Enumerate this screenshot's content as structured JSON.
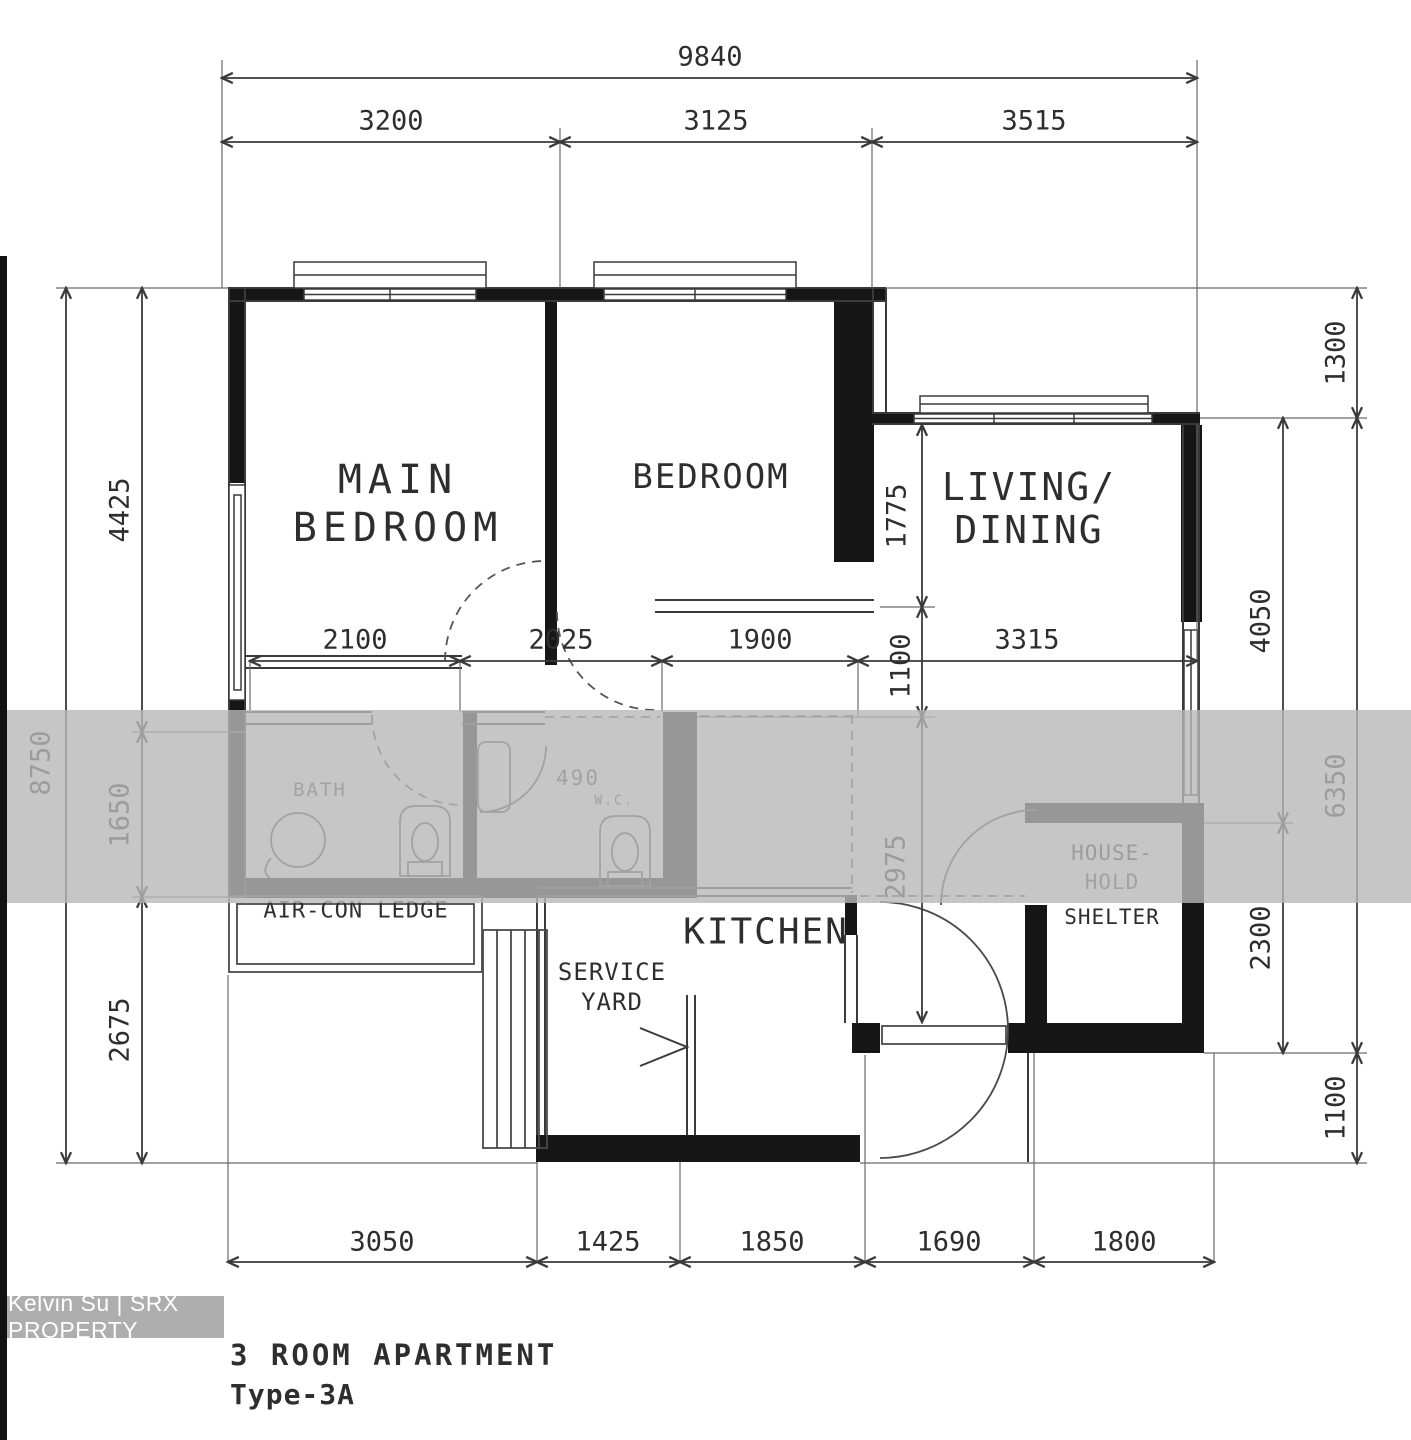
{
  "plan": {
    "title_line1": "3 ROOM APARTMENT",
    "title_line2": "Type-3A",
    "watermark_badge": "Kelvin Su | SRX PROPERTY",
    "rooms": {
      "main_bedroom": [
        "MAIN",
        "BEDROOM"
      ],
      "bedroom": "BEDROOM",
      "living_dining": [
        "LIVING/",
        "DINING"
      ],
      "kitchen": "KITCHEN",
      "service_yard": [
        "SERVICE",
        "YARD"
      ],
      "household_shelter": [
        "HOUSE-",
        "HOLD",
        "SHELTER"
      ],
      "aircon_ledge": "AIR-CON LEDGE",
      "bath1": "BATH",
      "bath2": [
        "490",
        "W.C."
      ]
    },
    "dimensions": {
      "top_total": "9840",
      "top_segments": [
        "3200",
        "3125",
        "3515"
      ],
      "left_total": "8750",
      "left_segments": [
        "4425",
        "1650",
        "2675"
      ],
      "right_outer_segments": [
        "1300",
        "6350",
        "1100"
      ],
      "right_inner_segments": [
        "4050",
        "2300"
      ],
      "middle_segments": [
        "2100",
        "2025",
        "1900",
        "3315"
      ],
      "interior_vertical_segments": [
        "1775",
        "1100",
        "2975"
      ],
      "bottom_segments": [
        "3050",
        "1425",
        "1850",
        "1690",
        "1800"
      ]
    },
    "colors": {
      "ink": "#2e2e2e",
      "wall_fill": "#161616",
      "watermark_band": "#b8b8b8",
      "badge_bg": "#aeaeae",
      "badge_text": "#ffffff",
      "paper": "#ffffff"
    }
  }
}
